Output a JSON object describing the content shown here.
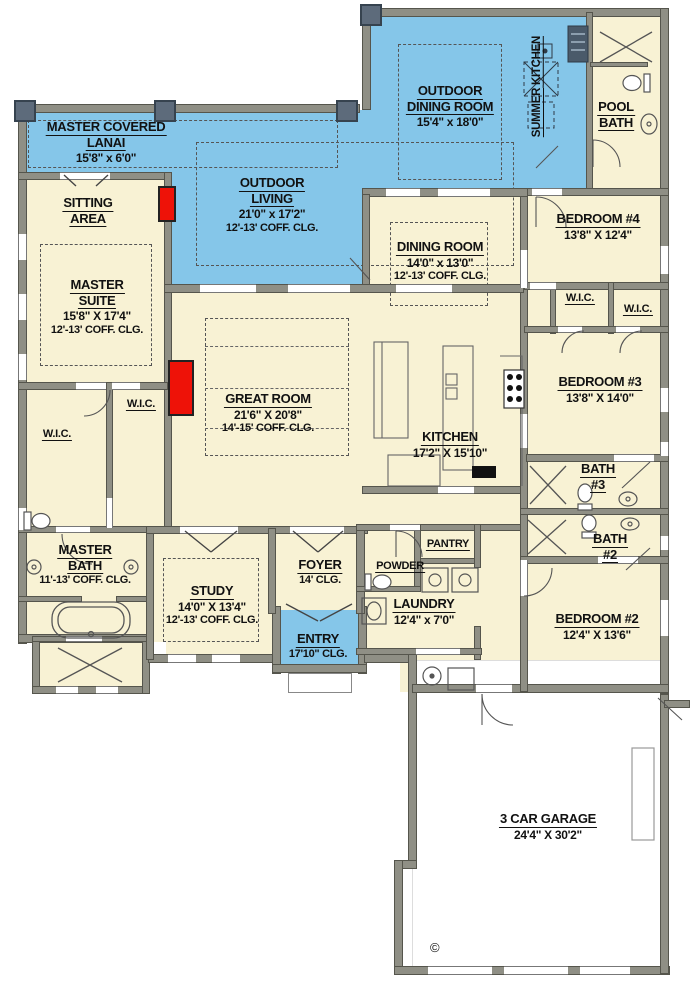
{
  "colors": {
    "outdoor_blue": "#85c6e9",
    "interior_cream": "#f8f2d4",
    "wall_gray": "#8f8f85",
    "pillar_slate": "#5d6b7b",
    "fireplace_red": "#ee1208",
    "garage_white": "#ffffff"
  },
  "rooms": {
    "master_covered_lanai": {
      "lines": [
        "MASTER COVERED",
        "LANAI"
      ],
      "dims": "15'8\" x 6'0\""
    },
    "outdoor_living": {
      "lines": [
        "OUTDOOR",
        "LIVING"
      ],
      "dims": "21'0\" x 17'2\"",
      "ceiling": "12'-13' COFF. CLG."
    },
    "outdoor_dining": {
      "lines": [
        "OUTDOOR",
        "DINING ROOM"
      ],
      "dims": "15'4\" x 18'0\""
    },
    "summer_kitchen": {
      "lines": [
        "SUMMER",
        "KITCHEN"
      ]
    },
    "pool_bath": {
      "lines": [
        "POOL",
        "BATH"
      ]
    },
    "sitting_area": {
      "lines": [
        "SITTING",
        "AREA"
      ]
    },
    "master_suite": {
      "lines": [
        "MASTER",
        "SUITE"
      ],
      "dims": "15'8\" X 17'4\"",
      "ceiling": "12'-13' COFF. CLG."
    },
    "bedroom_4": {
      "lines": [
        "BEDROOM #4"
      ],
      "dims": "13'8\" X 12'4\""
    },
    "dining_room": {
      "lines": [
        "DINING ROOM"
      ],
      "dims": "14'0\" x 13'0\"",
      "ceiling": "12'-13' COFF. CLG."
    },
    "wic_master_inner": {
      "lines": [
        "W.I.C."
      ]
    },
    "wic_master_left": {
      "lines": [
        "W.I.C."
      ]
    },
    "wic_bedroom4": {
      "lines": [
        "W.I.C."
      ]
    },
    "wic_bedroom3": {
      "lines": [
        "W.I.C."
      ]
    },
    "great_room": {
      "lines": [
        "GREAT ROOM"
      ],
      "dims": "21'6\" X 20'8\"",
      "ceiling": "14'-15' COFF. CLG."
    },
    "kitchen": {
      "lines": [
        "KITCHEN"
      ],
      "dims": "17'2\" X 15'10\""
    },
    "bedroom_3": {
      "lines": [
        "BEDROOM #3"
      ],
      "dims": "13'8\" X 14'0\""
    },
    "bath_3": {
      "lines": [
        "BATH",
        "#3"
      ]
    },
    "master_bath": {
      "lines": [
        "MASTER",
        "BATH"
      ],
      "ceiling": "11'-13' COFF. CLG."
    },
    "bath_2": {
      "lines": [
        "BATH",
        "#2"
      ]
    },
    "study": {
      "lines": [
        "STUDY"
      ],
      "dims": "14'0\" X 13'4\"",
      "ceiling": "12'-13' COFF. CLG."
    },
    "foyer": {
      "lines": [
        "FOYER"
      ],
      "ceiling": "14' CLG."
    },
    "powder": {
      "lines": [
        "POWDER"
      ]
    },
    "pantry": {
      "lines": [
        "PANTRY"
      ]
    },
    "laundry": {
      "lines": [
        "LAUNDRY"
      ],
      "dims": "12'4\" x 7'0\""
    },
    "entry": {
      "lines": [
        "ENTRY"
      ],
      "ceiling": "17'10\" CLG."
    },
    "bedroom_2": {
      "lines": [
        "BEDROOM #2"
      ],
      "dims": "12'4\" X 13'6\""
    },
    "garage": {
      "lines": [
        "3 CAR GARAGE"
      ],
      "dims": "24'4\" X 30'2\""
    }
  },
  "copyright": "©"
}
